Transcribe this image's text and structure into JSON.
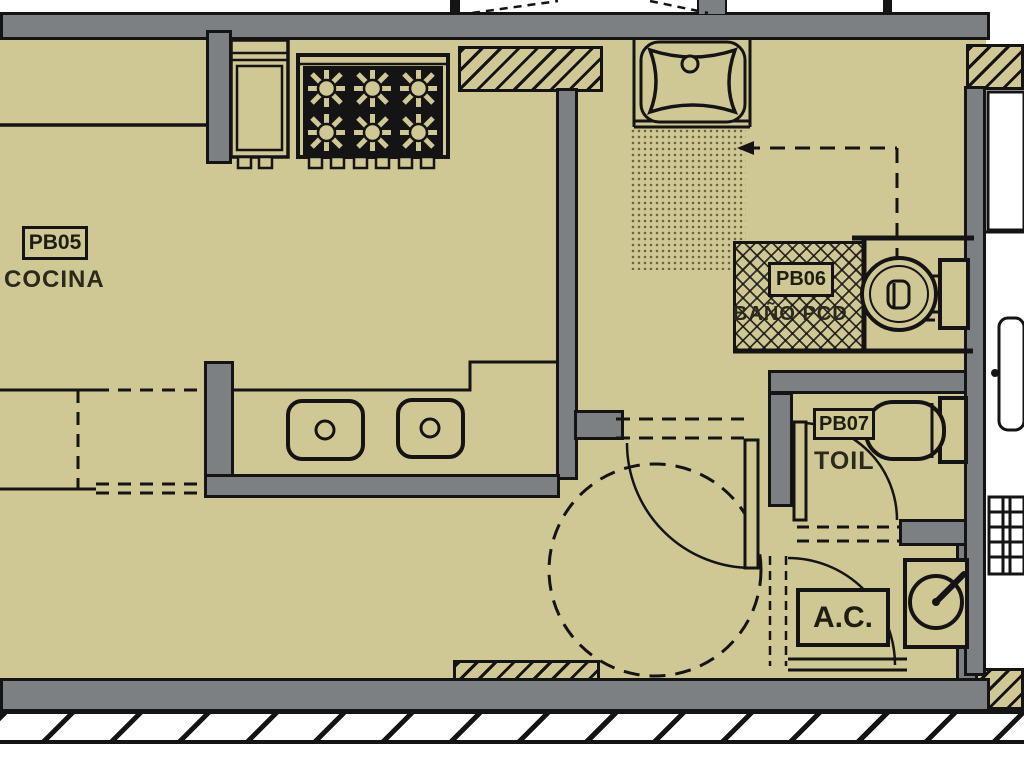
{
  "plan_title": "apartment floor plan",
  "rooms": {
    "kitchen": {
      "code": "PB05",
      "name": "COCINA"
    },
    "bathroom_pcd": {
      "code": "PB06",
      "name": "BAÑO PCD"
    },
    "toilet": {
      "code": "PB07",
      "name": "TOIL"
    },
    "ac_closet": {
      "label": "A.C."
    }
  },
  "colors": {
    "floor": "#cfc894",
    "wall": "#7d8083",
    "line": "#141414",
    "background": "#ffffff"
  }
}
